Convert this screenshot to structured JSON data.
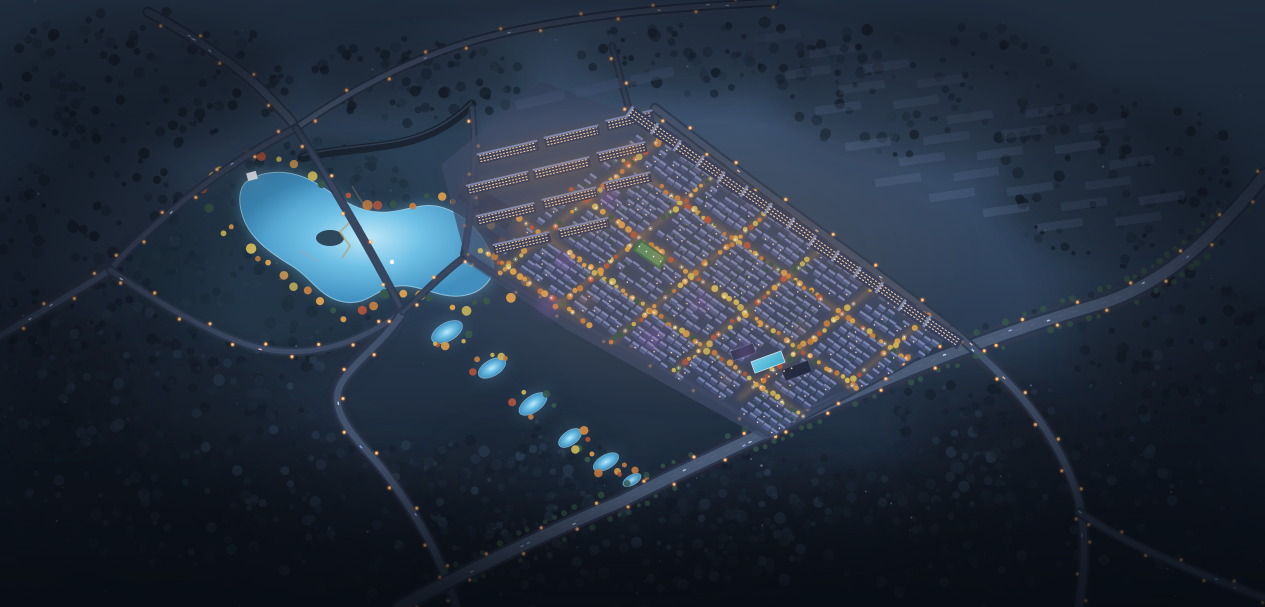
{
  "meta": {
    "kind": "aerial-night-rendering",
    "subject": "residential masterplan bird's-eye view at dusk",
    "width": 1265,
    "height": 607,
    "seed": 1337
  },
  "scene": {
    "palette": {
      "sky_top": "#46607f",
      "sky_mid": "#31445d",
      "sky_low": "#1d2939",
      "sky_bottom": "#131c29",
      "forest_dark": "#16202c",
      "forest_mid": "#1f2d3d",
      "forest_light": "#2a3c50",
      "road_surface": "#46566f",
      "road_minor": "#3a4760",
      "road_casing": "#2a3850",
      "trail_red": "#ff4553",
      "trail_pink": "#ff8b96",
      "trail_amber": "#ffc266",
      "lamp_glow": "#ff8c3a",
      "lamp_mid": "#ffb066",
      "lamp_core": "#ffe2b8",
      "lake_hi": "#bfe9f8",
      "lake_fill": "#6fc0e6",
      "lake_deep": "#3f8fc0",
      "lake_shore": "#a8ddf2",
      "villa_roof_dark": "#46527b",
      "villa_roof_mid": "#505d88",
      "villa_roof_deep": "#3f4a70",
      "villa_roof_light": "#7f8cb6",
      "villa_window": "#ffd9a2",
      "tree_gold": "#dba04e",
      "tree_yellow": "#cdb85a",
      "tree_orange": "#c77e3f",
      "tree_rust": "#b4543c",
      "tree_green": "#37584a",
      "hedge_green": "#2e4f44",
      "apt_base": "#333e5e",
      "apt_light": "#8d9cc6",
      "apt_window": "#ffd9a6",
      "apt_dim": "#4a5b7e",
      "context_fill": "#5a6d90",
      "wall": "#1c2634",
      "wall_hi": "#42546f",
      "park_base": "#23374a",
      "dark_building": "#222d44",
      "dark_building_edge": "#3c4c6a",
      "path_tan": "#8a7f63",
      "boardwalk": "#b8a57a",
      "bridge": "#9aa4b8",
      "site_base": "#3d4966",
      "pool": "#6fd2ee",
      "pool_deep": "#3aa8d0",
      "glow_warm": "#ff9a4d",
      "glow_purple": "#c06ae8",
      "haze": "#7b90b4",
      "street_glow": "#d08a3f",
      "street_core": "#ffb763",
      "street_lamp": "#fff3d2",
      "sparkle_blue": "#8ea6c9",
      "sparkle_dim": "#6f86a6",
      "sparkle_green": "#86b79a",
      "car_white": "#cfe0ff",
      "car_blue": "#9db8ff",
      "car_warm": "#ffc9b0",
      "vignette": "#070b12",
      "pavilion": "#eef2f8"
    },
    "sky_stops": [
      [
        0,
        "#46607f"
      ],
      [
        0.45,
        "#31445d"
      ],
      [
        0.78,
        "#1d2939"
      ],
      [
        1,
        "#141d2a"
      ]
    ],
    "mottles": [
      [
        200,
        120,
        180,
        70,
        "#3a506c",
        0.12
      ],
      [
        640,
        90,
        260,
        60,
        "#42587a",
        0.1
      ],
      [
        1020,
        120,
        220,
        80,
        "#455b7e",
        0.1
      ],
      [
        640,
        300,
        400,
        200,
        "#2c3e58",
        0.08
      ],
      [
        90,
        520,
        160,
        80,
        "#0d141f",
        0.28
      ],
      [
        1180,
        560,
        150,
        70,
        "#0c121c",
        0.3
      ],
      [
        350,
        420,
        200,
        90,
        "#15202e",
        0.2
      ],
      [
        1100,
        430,
        180,
        80,
        "#141e2b",
        0.2
      ]
    ],
    "hazes": [
      [
        1060,
        70,
        380,
        130,
        0.14
      ],
      [
        620,
        25,
        300,
        60,
        0.1
      ],
      [
        150,
        40,
        220,
        90,
        0.1
      ]
    ],
    "forest_zones": [
      [
        140,
        80,
        150,
        70,
        130
      ],
      [
        95,
        260,
        110,
        120,
        160
      ],
      [
        255,
        300,
        120,
        90,
        140
      ],
      [
        320,
        200,
        90,
        60,
        90
      ],
      [
        165,
        460,
        170,
        110,
        200
      ],
      [
        60,
        380,
        80,
        70,
        90
      ],
      [
        390,
        520,
        150,
        80,
        160
      ],
      [
        520,
        470,
        90,
        50,
        80
      ],
      [
        620,
        560,
        180,
        60,
        140
      ],
      [
        760,
        490,
        100,
        45,
        80
      ],
      [
        850,
        530,
        170,
        70,
        150
      ],
      [
        980,
        420,
        90,
        50,
        80
      ],
      [
        1060,
        500,
        170,
        90,
        170
      ],
      [
        1180,
        350,
        110,
        80,
        120
      ],
      [
        1120,
        180,
        120,
        90,
        100
      ],
      [
        930,
        90,
        160,
        70,
        90
      ],
      [
        700,
        55,
        120,
        40,
        70
      ],
      [
        420,
        80,
        110,
        45,
        80
      ]
    ],
    "sparkle_count": 110,
    "roads": [
      {
        "id": "highway-northwest",
        "d": "M148,12 C196,38 244,70 268,96 C281,110 290,118 296,128",
        "w": 7,
        "surf": "#46566f",
        "trails": [
          [
            "red",
            1.3,
            0.75,
            -1.2,
            1.5,
            ""
          ],
          [
            "pink",
            1,
            0.5,
            1.2,
            -1.5,
            ""
          ],
          [
            "amber",
            0.9,
            0.4,
            0,
            0,
            "12 9"
          ]
        ],
        "lampSp": 36,
        "cars": 4
      },
      {
        "id": "road-north-ridge",
        "d": "M296,128 C348,92 420,52 500,34 C590,13 680,7 775,2",
        "w": 5,
        "surf": "#4e5f7b",
        "trails": [
          [
            "red",
            1,
            0.45,
            0,
            1.2,
            ""
          ],
          [
            "amber",
            0.9,
            0.35,
            0,
            -1,
            "10 8"
          ]
        ],
        "lampSp": 40,
        "cars": 5
      },
      {
        "id": "road-west-loop-a",
        "d": "M296,128 C268,142 225,168 192,194 C158,222 128,248 110,270",
        "w": 5,
        "surf": "#3d4a63",
        "trails": [
          [
            "red",
            0.9,
            0.4,
            -1,
            -1.2,
            ""
          ]
        ],
        "lampSp": 34,
        "cars": 2
      },
      {
        "id": "road-west-exit",
        "d": "M110,270 C76,292 40,312 0,336",
        "w": 6,
        "surf": "#41506a",
        "trails": [
          [
            "red",
            1.2,
            0.8,
            -0.8,
            -1.8,
            ""
          ],
          [
            "red",
            1,
            0.5,
            0.8,
            1.8,
            ""
          ],
          [
            "amber",
            0.9,
            0.4,
            0,
            0,
            "10 7"
          ]
        ],
        "lampSp": 30,
        "cars": 2
      },
      {
        "id": "road-west-loop-b",
        "d": "M110,270 C152,298 205,332 252,346 C310,362 360,342 403,312",
        "w": 5,
        "surf": "#3d4a63",
        "trails": [
          [
            "amber",
            0.9,
            0.4,
            0,
            1.3,
            "14 10"
          ]
        ],
        "lampSp": 32,
        "cars": 2
      },
      {
        "id": "road-west-link",
        "d": "M296,128 C330,180 372,252 403,312",
        "w": 4.5,
        "surf": "#39465e",
        "trails": [],
        "lampSp": 38,
        "cars": 0
      },
      {
        "id": "road-southwest",
        "d": "M403,312 C384,342 356,360 342,382 C330,402 342,424 366,450 C394,480 420,522 436,554 C446,576 452,592 456,607",
        "w": 6.5,
        "surf": "#43526c",
        "trails": [
          [
            "red",
            1.2,
            0.7,
            -1.8,
            0.5,
            ""
          ],
          [
            "pink",
            1,
            0.45,
            1.8,
            -0.5,
            ""
          ],
          [
            "amber",
            0.8,
            0.35,
            0,
            0,
            "11 8"
          ]
        ],
        "lampSp": 32,
        "cars": 3
      },
      {
        "id": "road-park-link",
        "d": "M403,312 C425,292 444,272 466,256",
        "w": 3.5,
        "surf": "#39465e",
        "trails": [],
        "lampSp": 30,
        "cars": 0
      },
      {
        "id": "arterial-south",
        "d": "M400,607 C450,580 540,535 620,502 C700,462 790,420 880,382 C960,348 1030,324 1100,304 C1170,282 1220,230 1265,175",
        "w": 11,
        "surf": "#4b5b76",
        "casing": 16,
        "center": true,
        "treeRows": true,
        "trails": [
          [
            "red",
            1.5,
            0.85,
            0.9,
            2.4,
            ""
          ],
          [
            "red",
            1.3,
            0.7,
            -0.9,
            -2.4,
            ""
          ],
          [
            "pink",
            1,
            0.5,
            1.6,
            4.2,
            ""
          ],
          [
            "pink",
            0.9,
            0.4,
            -1.6,
            -4.2,
            ""
          ],
          [
            "amber",
            1.1,
            0.55,
            0.3,
            0.8,
            "18 12"
          ]
        ],
        "lampSp": 30,
        "cars": 14
      },
      {
        "id": "road-east-upper",
        "d": "M655,108 C720,158 798,216 862,262 C900,290 930,312 952,330",
        "w": 6,
        "surf": "#42516b",
        "trails": [
          [
            "red",
            0.9,
            0.4,
            -1.3,
            1.8,
            ""
          ]
        ],
        "lampSp": 28,
        "cars": 3
      },
      {
        "id": "road-east-lower",
        "d": "M952,330 C978,352 1002,374 1024,400 C1050,432 1068,464 1078,498 C1086,530 1086,566 1079,607",
        "w": 6.5,
        "surf": "#44536d",
        "trails": [
          [
            "red",
            1.2,
            0.7,
            -2,
            0.7,
            ""
          ],
          [
            "pink",
            0.9,
            0.45,
            2,
            -0.7,
            ""
          ],
          [
            "amber",
            0.8,
            0.4,
            0,
            0,
            "10 8"
          ]
        ],
        "lampSp": 28,
        "cars": 4
      },
      {
        "id": "road-southeast-branch",
        "d": "M1079,512 C1122,542 1182,568 1265,598",
        "w": 5.5,
        "surf": "#40506a",
        "trails": [
          [
            "red",
            0.9,
            0.5,
            -0.6,
            1.6,
            ""
          ],
          [
            "amber",
            0.8,
            0.35,
            0.6,
            -1.6,
            "9 7"
          ]
        ],
        "lampSp": 30,
        "cars": 3
      },
      {
        "id": "road-site-connector",
        "d": "M612,46 C618,66 622,86 630,112",
        "w": 3.5,
        "surf": "#39465e",
        "trails": [],
        "lampSp": 24,
        "cars": 0
      },
      {
        "id": "road-site-west",
        "d": "M472,108 C477,160 472,210 464,254",
        "w": 3.5,
        "surf": "#3a4760",
        "trails": [],
        "lampSp": 26,
        "cars": 0
      },
      {
        "id": "road-site-southwest",
        "d": "M464,254 C520,292 578,324 634,352 C688,382 740,412 772,436",
        "w": 3.5,
        "surf": "#3a4760",
        "trails": [],
        "lampSp": 26,
        "cars": 0
      },
      {
        "id": "road-site-southeast",
        "d": "M772,436 C812,408 878,384 948,336",
        "w": 3.5,
        "surf": "#3a4760",
        "trails": [],
        "lampSp": 28,
        "cars": 0
      }
    ],
    "park": {
      "base_poly": "M238,168 L320,142 L420,126 L470,104 L482,150 L470,256 L430,300 L403,312 L330,340 L252,346 L180,324 L120,268 L196,196 Z",
      "wall_d": "M302,158 C330,150 360,150 394,144 C428,138 452,124 472,104",
      "lake_d": "M246,182 C266,168 292,170 314,182 C338,196 352,210 378,212 C404,214 420,200 444,208 C468,216 486,238 492,258 C498,278 482,294 460,296 C438,298 420,284 398,286 C376,288 368,306 344,302 C320,298 312,278 292,266 C272,254 252,240 244,220 C238,204 238,190 246,182 Z",
      "lake_centroid": [
        368,
        240
      ],
      "island": [
        330,
        238,
        14,
        8
      ],
      "ponds": [
        [
          447,
          332,
          17,
          9,
          -30
        ],
        [
          492,
          368,
          15,
          8,
          -30
        ],
        [
          533,
          404,
          16,
          8,
          -35
        ],
        [
          570,
          438,
          13,
          7,
          -35
        ],
        [
          606,
          462,
          14,
          7,
          -30
        ],
        [
          632,
          480,
          10,
          5,
          -30
        ]
      ],
      "paths": [
        "M300,196 C330,224 352,252 372,282",
        "M352,186 C368,214 388,238 416,256",
        "M262,210 C288,232 312,252 338,268"
      ],
      "boardwalk": "M342,206 L352,220 L340,232 L350,246 L342,258",
      "bridges": [
        "M348,212 L362,228",
        "M300,250 L318,262"
      ],
      "dark_buildings": [
        [
          487,
          205,
          60,
          22,
          33
        ],
        [
          490,
          245,
          70,
          26,
          33
        ],
        [
          452,
          270,
          34,
          13,
          33
        ]
      ],
      "pavilion": [
        252,
        176,
        10,
        8,
        -15
      ],
      "fountain": [
        392,
        262
      ],
      "tree_ring_step": 13,
      "pond_trees": 5
    },
    "site": {
      "origin": [
        650,
        110
      ],
      "u_axis": [
        0.82,
        0.57
      ],
      "v_axis": [
        -0.77,
        0.64
      ],
      "base_poly_uv": [
        [
          -95,
          40
        ],
        [
          15,
          8
        ],
        [
          383,
          6
        ],
        [
          341,
          212
        ],
        [
          120,
          236
        ],
        [
          0,
          238
        ],
        [
          -95,
          170
        ]
      ],
      "grid": {
        "u_min": 16,
        "u_max": 380,
        "v_min": 14,
        "du": 9,
        "dv": 8.5,
        "vmax_points": [
          [
            0,
            224
          ],
          [
            120,
            224
          ],
          [
            280,
            204
          ],
          [
            341,
            208
          ],
          [
            383,
            16
          ]
        ],
        "carves": [
          {
            "u0": 100,
            "u1": 132,
            "v0": 106,
            "v1": 138
          },
          {
            "u0": 264,
            "u1": 298,
            "v0": 128,
            "v1": 164
          }
        ]
      },
      "streets": {
        "u_lines": [
          [
            30,
            18,
            232
          ],
          [
            95,
            16,
            228
          ],
          [
            160,
            14,
            224
          ],
          [
            225,
            14,
            214
          ],
          [
            290,
            12,
            200
          ],
          [
            350,
            10,
            120
          ]
        ],
        "v_lines": [
          [
            60,
            24,
            372
          ],
          [
            115,
            10,
            362
          ],
          [
            170,
            2,
            350
          ],
          [
            218,
            0,
            130
          ],
          [
            14,
            0,
            380
          ]
        ]
      },
      "green_court": {
        "pos": [
          650,
          254
        ],
        "rot": 35,
        "w": 34,
        "h": 14,
        "fill": "#3c6a4e",
        "inner": "#5e9266"
      },
      "purple_glows": [
        [
          565,
          262
        ],
        [
          652,
          338
        ],
        [
          608,
          196
        ],
        [
          700,
          302
        ],
        [
          548,
          306
        ],
        [
          745,
          352
        ]
      ],
      "warm_spots": [
        [
          520,
          230
        ],
        [
          585,
          300
        ],
        [
          660,
          255
        ],
        [
          725,
          380
        ],
        [
          800,
          330
        ],
        [
          630,
          150
        ]
      ],
      "bloom": [
        [
          700,
          260,
          290,
          160,
          0.1
        ],
        [
          565,
          175,
          130,
          75,
          0.12
        ]
      ]
    },
    "apartments": {
      "nw_slabs": [
        [
          508,
          152,
          62
        ],
        [
          572,
          136,
          56
        ],
        [
          630,
          120,
          48
        ],
        [
          498,
          183,
          64
        ],
        [
          562,
          168,
          58
        ],
        [
          622,
          152,
          50
        ],
        [
          506,
          214,
          60
        ],
        [
          570,
          198,
          56
        ],
        [
          628,
          182,
          48
        ],
        [
          522,
          243,
          58
        ],
        [
          584,
          228,
          52
        ]
      ],
      "nw_rot": -13,
      "nw_h": 11,
      "dim_slabs": [
        [
          540,
          100,
          50
        ],
        [
          598,
          88,
          46
        ],
        [
          652,
          76,
          44
        ]
      ],
      "ne_row": {
        "from": [
          655,
          112
        ],
        "to": [
          950,
          320
        ],
        "count": 14,
        "offset": [
          -8,
          11.5
        ],
        "rot": -56,
        "slab_w": 13,
        "slab_h": 42
      }
    },
    "context_blocks": {
      "x0": 778,
      "y0": 36,
      "di_x": 54,
      "di_y": 15,
      "dj_x": 30,
      "dj_y": 36,
      "cols": 7,
      "rows": 5,
      "w": 46,
      "h": 8.5,
      "rot": -8,
      "max_x": 1185,
      "max_y": 225,
      "skip": 0.22
    },
    "amenity": {
      "center": [
        768,
        362
      ],
      "rot": -20,
      "pool": [
        32,
        12
      ],
      "bldg1": [
        748,
        344,
        24,
        10
      ],
      "bldg2": [
        792,
        380,
        28,
        12
      ],
      "plaza": [
        770,
        390
      ]
    }
  }
}
